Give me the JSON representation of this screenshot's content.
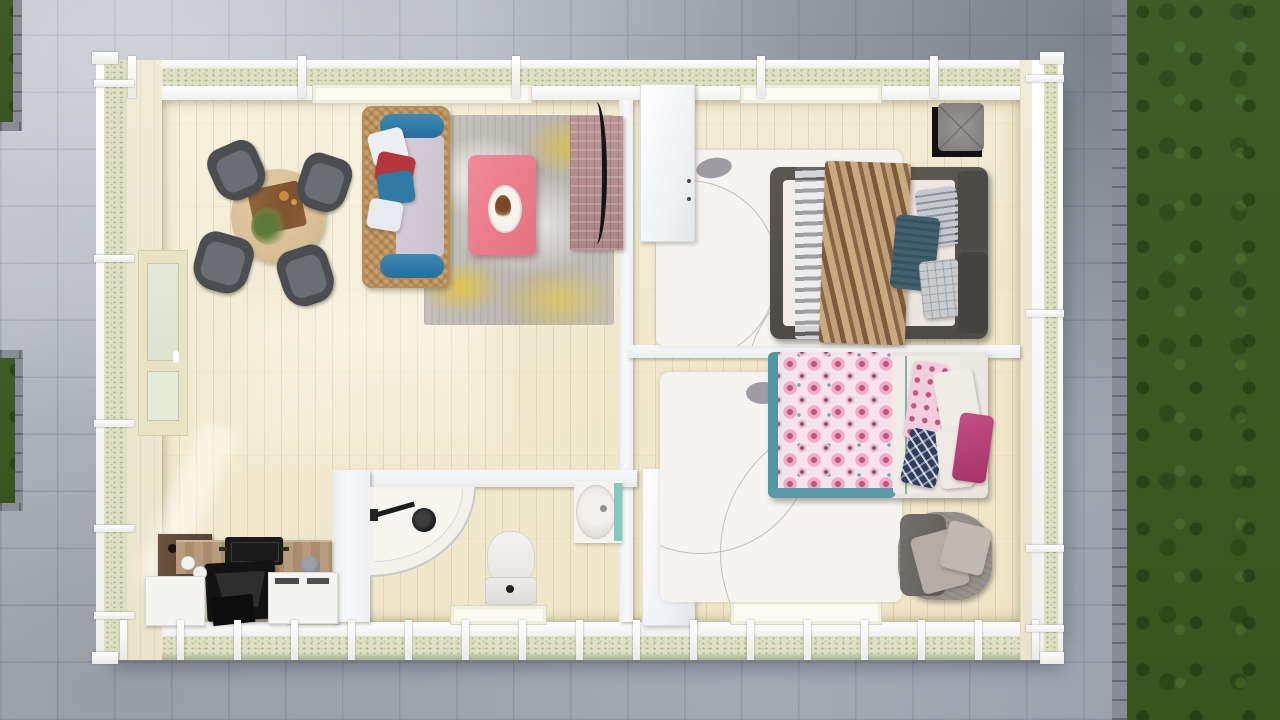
{
  "scene": {
    "title": "Top view 3D floor plan render of a small one-storey house",
    "view": "top-down 3D architectural visualization",
    "environment": [
      "gray paved stone patio surrounding the house",
      "green lawn strip on the right edge",
      "two small lawn patches on the left edge"
    ]
  },
  "rooms": [
    {
      "name": "living-dining-room",
      "furniture": [
        "round wooden dining table with centerpiece board and green plant",
        "four dark gray dining chairs",
        "rattan sofa with blue bolsters and white-red-blue cushions",
        "distressed gray-yellow area rug",
        "pink coffee table with oval decor tray",
        "rosewood TV console with curved black TV"
      ]
    },
    {
      "name": "bedroom-1",
      "furniture": [
        "double bed with dark gray frame and white mattress",
        "sheer gray striped runner",
        "brown striped throw blanket",
        "striped gray pillow",
        "teal pillow",
        "plaid gray pillow",
        "two dark headboard cushions",
        "black bedside cube with gray tufted cushion",
        "white area rug with curved lines"
      ]
    },
    {
      "name": "bedroom-2",
      "furniture": [
        "double bed with pink medallion-pattern duvet and teal trim",
        "white sheet section",
        "pink patterned pillow",
        "two white pillows",
        "navy geometric pillow",
        "magenta pillow",
        "gray rattan armchair with two beige cushions",
        "white area rug with curved lines"
      ]
    },
    {
      "name": "bathroom",
      "furniture": [
        "corner quarter-circle shower with curved glass and black shower head",
        "toilet with cistern and flush button",
        "oval washbasin with mint splashback"
      ]
    },
    {
      "name": "kitchen",
      "furniture": [
        "wooden countertop",
        "black cooktop",
        "black range hood",
        "dark walnut prep counter",
        "white base cabinets",
        "paper towel rolls",
        "gray pot"
      ]
    }
  ],
  "palette": {
    "grass": "#3f5d29",
    "pavement": "#abb0ba",
    "insulation": "#dde0c2",
    "floor": "#efe5c6",
    "wall-white": "#f7f8fa",
    "sofa-blue": "#2e7dab",
    "pillow-red": "#b5373d",
    "coffee-table-pink": "#ec7f8f",
    "tv-console-mauve": "#b18e8e",
    "chair-gray": "#4b4e51",
    "bed1-frame": "#56514d",
    "blanket-brown": "#8a6547",
    "pillow-teal": "#42606f",
    "bed2-teal": "#4f98a4",
    "duvet-pink": "#e06a9a",
    "pillow-navy": "#2f3c60",
    "pillow-magenta": "#b54078",
    "splashback-mint": "#84cabc",
    "kitchen-wood": "#b69b7c",
    "appliance-black": "#161616"
  }
}
